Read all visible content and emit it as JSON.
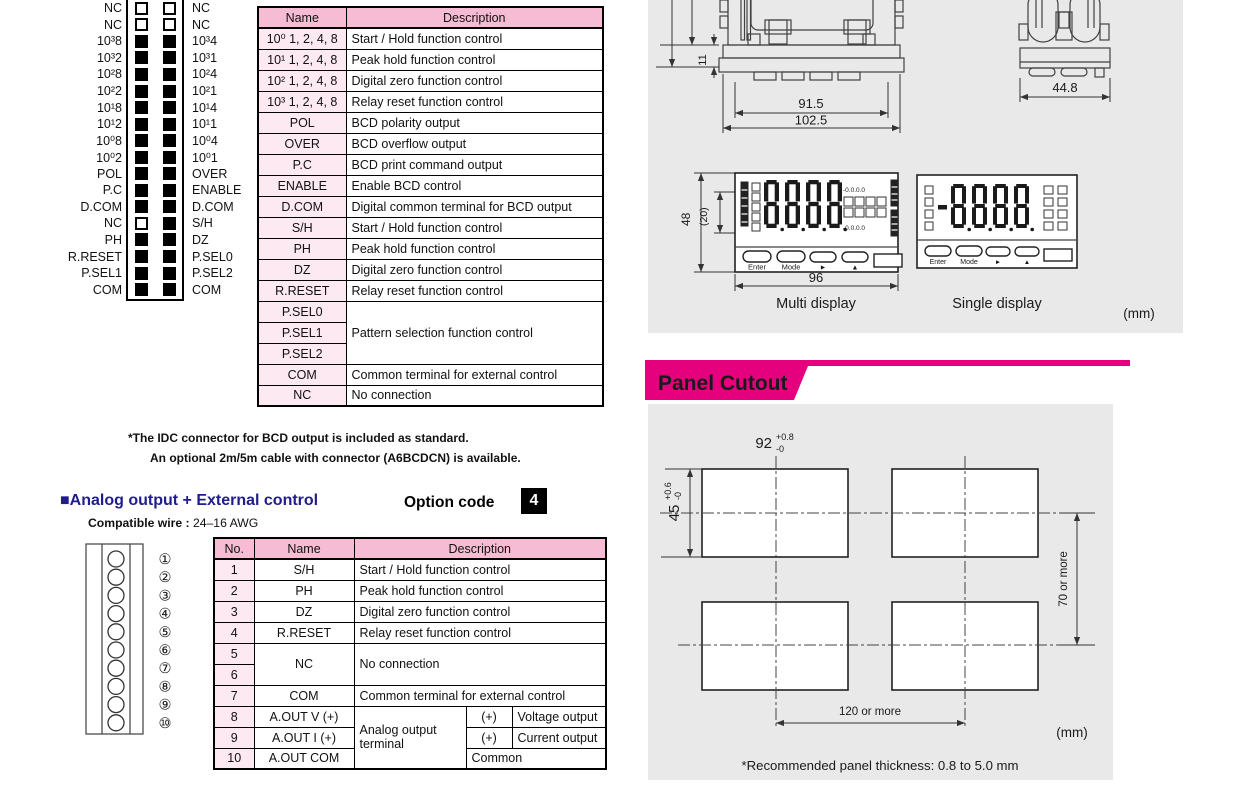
{
  "colors": {
    "magenta": "#e5007d",
    "header_pink": "#f6bcd3",
    "cell_pink": "#fde9f2",
    "navy": "#201c8e",
    "panel_gray": "#e9e9e9"
  },
  "bcd": {
    "pins": [
      {
        "l": "NC",
        "r": "NC",
        "lf": false,
        "rf": false
      },
      {
        "l": "NC",
        "r": "NC",
        "lf": false,
        "rf": false
      },
      {
        "l": "10³8",
        "r": "10³4",
        "lf": true,
        "rf": true
      },
      {
        "l": "10³2",
        "r": "10³1",
        "lf": true,
        "rf": true
      },
      {
        "l": "10²8",
        "r": "10²4",
        "lf": true,
        "rf": true
      },
      {
        "l": "10²2",
        "r": "10²1",
        "lf": true,
        "rf": true
      },
      {
        "l": "10¹8",
        "r": "10¹4",
        "lf": true,
        "rf": true
      },
      {
        "l": "10¹2",
        "r": "10¹1",
        "lf": true,
        "rf": true
      },
      {
        "l": "10⁰8",
        "r": "10⁰4",
        "lf": true,
        "rf": true
      },
      {
        "l": "10⁰2",
        "r": "10⁰1",
        "lf": true,
        "rf": true
      },
      {
        "l": "POL",
        "r": "OVER",
        "lf": true,
        "rf": true
      },
      {
        "l": "P.C",
        "r": "ENABLE",
        "lf": true,
        "rf": true
      },
      {
        "l": "D.COM",
        "r": "D.COM",
        "lf": true,
        "rf": true
      },
      {
        "l": "NC",
        "r": "S/H",
        "lf": false,
        "rf": true
      },
      {
        "l": "PH",
        "r": "DZ",
        "lf": true,
        "rf": true
      },
      {
        "l": "R.RESET",
        "r": "P.SEL0",
        "lf": true,
        "rf": true
      },
      {
        "l": "P.SEL1",
        "r": "P.SEL2",
        "lf": true,
        "rf": true
      },
      {
        "l": "COM",
        "r": "COM",
        "lf": true,
        "rf": true
      }
    ],
    "table": {
      "header": [
        {
          "t": "Name"
        },
        {
          "t": "Description"
        }
      ],
      "rows": [
        {
          "cells": [
            {
              "t": "10⁰ 1, 2, 4, 8",
              "p": true
            },
            {
              "t": "Start / Hold function control",
              "l": true
            }
          ]
        },
        {
          "cells": [
            {
              "t": "10¹ 1, 2, 4, 8",
              "p": true
            },
            {
              "t": "Peak hold function control",
              "l": true
            }
          ]
        },
        {
          "cells": [
            {
              "t": "10² 1, 2, 4, 8",
              "p": true
            },
            {
              "t": "Digital zero function control",
              "l": true
            }
          ]
        },
        {
          "cells": [
            {
              "t": "10³ 1, 2, 4, 8",
              "p": true
            },
            {
              "t": "Relay reset function control",
              "l": true
            }
          ]
        },
        {
          "cells": [
            {
              "t": "POL",
              "p": true
            },
            {
              "t": "BCD polarity output",
              "l": true
            }
          ]
        },
        {
          "cells": [
            {
              "t": "OVER",
              "p": true
            },
            {
              "t": "BCD overflow output",
              "l": true
            }
          ]
        },
        {
          "cells": [
            {
              "t": "P.C",
              "p": true
            },
            {
              "t": "BCD print command output",
              "l": true
            }
          ]
        },
        {
          "cells": [
            {
              "t": "ENABLE",
              "p": true
            },
            {
              "t": "Enable BCD control",
              "l": true
            }
          ]
        },
        {
          "cells": [
            {
              "t": "D.COM",
              "p": true
            },
            {
              "t": "Digital common terminal for BCD output",
              "l": true
            }
          ]
        },
        {
          "cells": [
            {
              "t": "S/H",
              "p": true
            },
            {
              "t": "Start / Hold function control",
              "l": true
            }
          ]
        },
        {
          "cells": [
            {
              "t": "PH",
              "p": true
            },
            {
              "t": "Peak hold function control",
              "l": true
            }
          ]
        },
        {
          "cells": [
            {
              "t": "DZ",
              "p": true
            },
            {
              "t": "Digital zero function control",
              "l": true
            }
          ]
        },
        {
          "cells": [
            {
              "t": "R.RESET",
              "p": true
            },
            {
              "t": "Relay reset function control",
              "l": true
            }
          ]
        },
        {
          "cells": [
            {
              "t": "P.SEL0",
              "p": true
            },
            {
              "t": "Pattern selection function control",
              "l": true,
              "rs": 3
            }
          ]
        },
        {
          "cells": [
            {
              "t": "P.SEL1",
              "p": true
            }
          ]
        },
        {
          "cells": [
            {
              "t": "P.SEL2",
              "p": true
            }
          ]
        },
        {
          "cells": [
            {
              "t": "COM",
              "p": true
            },
            {
              "t": "Common terminal for external control",
              "l": true
            }
          ]
        },
        {
          "cells": [
            {
              "t": "NC",
              "p": true
            },
            {
              "t": "No connection",
              "l": true
            }
          ]
        }
      ]
    },
    "notes": [
      "*The IDC connector for BCD output is included as standard.",
      "An optional 2m/5m cable with connector (A6BCDCN) is available."
    ]
  },
  "analog": {
    "title": "■Analog output + External control",
    "option_code_label": "Option code",
    "option_code": "4",
    "compatible_wire_label": "Compatible wire :",
    "compatible_wire_value": "24–16 AWG",
    "terminal_numbers": [
      "①",
      "②",
      "③",
      "④",
      "⑤",
      "⑥",
      "⑦",
      "⑧",
      "⑨",
      "⑩"
    ],
    "table": {
      "header": [
        {
          "t": "No."
        },
        {
          "t": "Name"
        },
        {
          "t": "Description",
          "span": 3
        }
      ],
      "rows": [
        {
          "cells": [
            {
              "t": "1",
              "p": true
            },
            {
              "t": "S/H"
            },
            {
              "t": "Start / Hold function control",
              "span": 3,
              "l": true
            }
          ]
        },
        {
          "cells": [
            {
              "t": "2",
              "p": true
            },
            {
              "t": "PH"
            },
            {
              "t": "Peak hold function control",
              "span": 3,
              "l": true
            }
          ]
        },
        {
          "cells": [
            {
              "t": "3",
              "p": true
            },
            {
              "t": "DZ"
            },
            {
              "t": "Digital zero function control",
              "span": 3,
              "l": true
            }
          ]
        },
        {
          "cells": [
            {
              "t": "4",
              "p": true
            },
            {
              "t": "R.RESET"
            },
            {
              "t": "Relay reset function control",
              "span": 3,
              "l": true
            }
          ]
        },
        {
          "cells": [
            {
              "t": "5",
              "p": true
            },
            {
              "t": "NC",
              "rs": 2
            },
            {
              "t": "No connection",
              "span": 3,
              "rs": 2,
              "l": true
            }
          ]
        },
        {
          "cells": [
            {
              "t": "6",
              "p": true
            }
          ]
        },
        {
          "cells": [
            {
              "t": "7",
              "p": true
            },
            {
              "t": "COM"
            },
            {
              "t": "Common terminal for external control",
              "span": 3,
              "l": true
            }
          ]
        },
        {
          "cells": [
            {
              "t": "8",
              "p": true
            },
            {
              "t": "A.OUT V (+)"
            },
            {
              "t": "Analog output terminal",
              "rs": 3,
              "l": true
            },
            {
              "t": "(+)"
            },
            {
              "t": "Voltage output",
              "l": true
            }
          ]
        },
        {
          "cells": [
            {
              "t": "9",
              "p": true
            },
            {
              "t": "A.OUT I (+)"
            },
            {
              "t": "(+)"
            },
            {
              "t": "Current output",
              "l": true
            }
          ]
        },
        {
          "cells": [
            {
              "t": "10",
              "p": true
            },
            {
              "t": "A.OUT COM"
            },
            {
              "t": "Common",
              "span": 2,
              "l": true
            }
          ]
        }
      ]
    }
  },
  "dimensions": {
    "flange_thickness": "11",
    "rear_width_inner": "91.5",
    "rear_width_outer": "102.5",
    "side_width": "44.8",
    "panel_height": "48",
    "display_height": "(20)",
    "panel_width": "96",
    "multi_label": "Multi display",
    "single_label": "Single display",
    "unit": "(mm)",
    "sub_digits": "-0.0.0.0",
    "buttons": [
      "Enter",
      "Mode",
      "►",
      "▲"
    ]
  },
  "panel_cutout": {
    "title": "Panel Cutout",
    "width_dim": "92",
    "width_tol_plus": "+0.8",
    "width_tol_minus": "-0",
    "height_dim": "45",
    "height_tol_plus": "+0.6",
    "height_tol_minus": "-0",
    "vertical_spacing": "70 or more",
    "horizontal_spacing": "120 or more",
    "unit": "(mm)",
    "note": "*Recommended panel thickness: 0.8 to 5.0 mm"
  }
}
